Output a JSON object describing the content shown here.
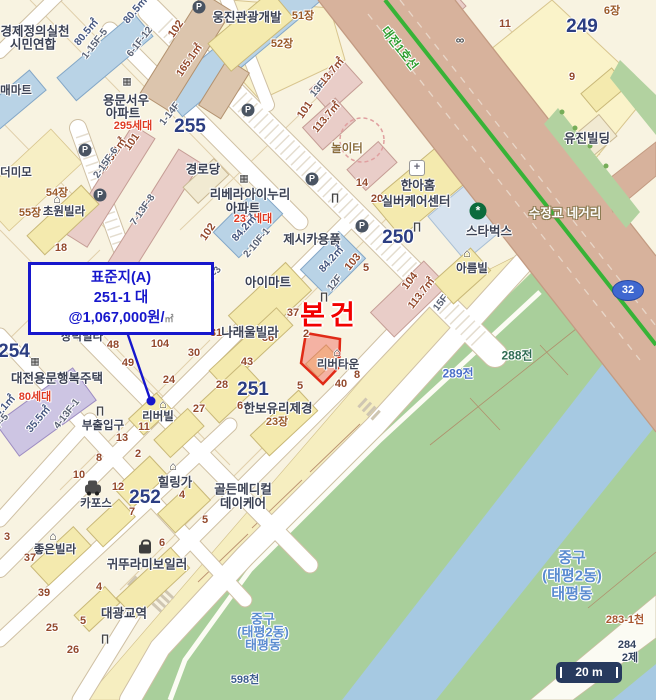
{
  "map": {
    "route_badge": "32",
    "scale_label": "20 m",
    "accent_colors": {
      "subject_red": "#f20000",
      "callout_blue": "#1717cc",
      "subway_green": "#37b337",
      "water": "#a6c9e2",
      "park_green": "#a9cf9b",
      "road_tan": "#d7b29c"
    }
  },
  "callout": {
    "line1": "표준지(A)",
    "line2": "251-1 대",
    "line3": "@1,067,000원/",
    "unit": "㎡"
  },
  "labels": [
    {
      "t": "경제정의실천",
      "x": 35,
      "y": 30,
      "c": "bldg13"
    },
    {
      "t": "시민연합",
      "x": 33,
      "y": 43,
      "c": "bldg13"
    },
    {
      "t": "80.5㎡",
      "x": 86,
      "y": 32,
      "c": "areaB",
      "r": -50
    },
    {
      "t": "80.5㎡",
      "x": 135,
      "y": 10,
      "c": "areaB",
      "r": -50
    },
    {
      "t": "1-15F-5",
      "x": 95,
      "y": 44,
      "c": "floor",
      "r": -52
    },
    {
      "t": "6-1F-12",
      "x": 140,
      "y": 42,
      "c": "floor",
      "r": -52
    },
    {
      "t": "102",
      "x": 176,
      "y": 29,
      "c": "pnum",
      "r": -55
    },
    {
      "t": "165.1㎡",
      "x": 189,
      "y": 60,
      "c": "areaM",
      "r": -55
    },
    {
      "t": "매마트",
      "x": 16,
      "y": 90,
      "c": "bldg12"
    },
    {
      "t": "웅진관광개발",
      "x": 247,
      "y": 16,
      "c": "bldg13"
    },
    {
      "t": "51장",
      "x": 303,
      "y": 15,
      "c": "jang"
    },
    {
      "t": "52장",
      "x": 282,
      "y": 43,
      "c": "jang"
    },
    {
      "t": "용문서우",
      "x": 126,
      "y": 99,
      "c": "bldg13"
    },
    {
      "t": "아파트",
      "x": 123,
      "y": 112,
      "c": "bldg13"
    },
    {
      "t": "1-14F",
      "x": 170,
      "y": 114,
      "c": "floor",
      "r": -52
    },
    {
      "t": "295세대",
      "x": 133,
      "y": 125,
      "c": "red11"
    },
    {
      "t": "255",
      "x": 190,
      "y": 127,
      "c": "bignum"
    },
    {
      "t": "101",
      "x": 132,
      "y": 142,
      "c": "pnum",
      "r": -55
    },
    {
      "t": "103.2㎡",
      "x": 113,
      "y": 154,
      "c": "areaM",
      "r": -55
    },
    {
      "t": "2-15F-6",
      "x": 106,
      "y": 163,
      "c": "floor",
      "r": -55
    },
    {
      "t": "7-13F-8",
      "x": 143,
      "y": 210,
      "c": "floor",
      "r": -55
    },
    {
      "t": "더미모",
      "x": 16,
      "y": 172,
      "c": "bldg12"
    },
    {
      "t": "54장",
      "x": 57,
      "y": 192,
      "c": "jang"
    },
    {
      "t": "55장",
      "x": 30,
      "y": 212,
      "c": "jang"
    },
    {
      "t": "초원빌라",
      "x": 64,
      "y": 211,
      "c": "bldg12"
    },
    {
      "t": "18",
      "x": 61,
      "y": 248,
      "c": "pnum"
    },
    {
      "t": "113.7㎡",
      "x": 330,
      "y": 73,
      "c": "areaM",
      "r": -50
    },
    {
      "t": "13F",
      "x": 318,
      "y": 89,
      "c": "floor",
      "r": -50
    },
    {
      "t": "101",
      "x": 305,
      "y": 110,
      "c": "pnum",
      "r": -55
    },
    {
      "t": "113.7㎡",
      "x": 326,
      "y": 117,
      "c": "areaM",
      "r": -50
    },
    {
      "t": "놀이터",
      "x": 347,
      "y": 148,
      "c": "play"
    },
    {
      "t": "경로당",
      "x": 203,
      "y": 168,
      "c": "bldg13"
    },
    {
      "t": "리베라아이누리",
      "x": 250,
      "y": 193,
      "c": "bldg13"
    },
    {
      "t": "아파트",
      "x": 243,
      "y": 207,
      "c": "bldg13"
    },
    {
      "t": "232세대",
      "x": 253,
      "y": 218,
      "c": "red11"
    },
    {
      "t": "84.2㎡",
      "x": 244,
      "y": 228,
      "c": "areaB",
      "r": -48
    },
    {
      "t": "2-10F-1",
      "x": 257,
      "y": 243,
      "c": "floor",
      "r": -50
    },
    {
      "t": "102",
      "x": 208,
      "y": 232,
      "c": "pnum",
      "r": -55
    },
    {
      "t": "2-9F-3",
      "x": 211,
      "y": 280,
      "c": "floor",
      "r": -55
    },
    {
      "t": "제시카용품",
      "x": 312,
      "y": 238,
      "c": "bldg13"
    },
    {
      "t": "84.2㎡",
      "x": 331,
      "y": 259,
      "c": "areaB",
      "r": -48
    },
    {
      "t": "103",
      "x": 353,
      "y": 262,
      "c": "pnum",
      "r": -50
    },
    {
      "t": "5",
      "x": 366,
      "y": 268,
      "c": "pnum"
    },
    {
      "t": "250",
      "x": 398,
      "y": 238,
      "c": "bignum"
    },
    {
      "t": "14",
      "x": 362,
      "y": 183,
      "c": "pnum"
    },
    {
      "t": "20",
      "x": 377,
      "y": 199,
      "c": "pnum"
    },
    {
      "t": "한아홈",
      "x": 418,
      "y": 184,
      "c": "bldg13"
    },
    {
      "t": "실버케어센터",
      "x": 416,
      "y": 200,
      "c": "bldg13"
    },
    {
      "t": "스타벅스",
      "x": 489,
      "y": 230,
      "c": "bldg13"
    },
    {
      "t": "아름빌",
      "x": 472,
      "y": 268,
      "c": "bldg12"
    },
    {
      "t": "104",
      "x": 410,
      "y": 281,
      "c": "pnum",
      "r": -52
    },
    {
      "t": "113.7㎡",
      "x": 421,
      "y": 293,
      "c": "areaM",
      "r": -52
    },
    {
      "t": "15F",
      "x": 441,
      "y": 303,
      "c": "floor",
      "r": -52
    },
    {
      "t": "12F",
      "x": 335,
      "y": 283,
      "c": "floor",
      "r": -52
    },
    {
      "t": "본건",
      "x": 330,
      "y": 313,
      "c": "subject",
      "n": "subject-property-label"
    },
    {
      "t": "리버타운",
      "x": 338,
      "y": 364,
      "c": "bldg12"
    },
    {
      "t": "37",
      "x": 293,
      "y": 313,
      "c": "pnum"
    },
    {
      "t": "2",
      "x": 306,
      "y": 334,
      "c": "pnum"
    },
    {
      "t": "5",
      "x": 300,
      "y": 386,
      "c": "pnum"
    },
    {
      "t": "40",
      "x": 341,
      "y": 384,
      "c": "pnum"
    },
    {
      "t": "8",
      "x": 357,
      "y": 375,
      "c": "pnum"
    },
    {
      "t": "아이마트",
      "x": 268,
      "y": 281,
      "c": "bldg13"
    },
    {
      "t": "36",
      "x": 268,
      "y": 338,
      "c": "pnum"
    },
    {
      "t": "31",
      "x": 216,
      "y": 333,
      "c": "pnum"
    },
    {
      "t": "나래울빌라",
      "x": 250,
      "y": 331,
      "c": "bldg13"
    },
    {
      "t": "104",
      "x": 160,
      "y": 344,
      "c": "pnum"
    },
    {
      "t": "30",
      "x": 194,
      "y": 353,
      "c": "pnum"
    },
    {
      "t": "43",
      "x": 247,
      "y": 362,
      "c": "pnum"
    },
    {
      "t": "24",
      "x": 169,
      "y": 380,
      "c": "pnum"
    },
    {
      "t": "28",
      "x": 222,
      "y": 385,
      "c": "pnum"
    },
    {
      "t": "251",
      "x": 253,
      "y": 390,
      "c": "bignum"
    },
    {
      "t": "6",
      "x": 240,
      "y": 406,
      "c": "pnum"
    },
    {
      "t": "한보유리제경",
      "x": 278,
      "y": 407,
      "c": "bldg13"
    },
    {
      "t": "23장",
      "x": 277,
      "y": 421,
      "c": "jang"
    },
    {
      "t": "27",
      "x": 199,
      "y": 409,
      "c": "pnum"
    },
    {
      "t": "리버빌",
      "x": 158,
      "y": 416,
      "c": "bldg12"
    },
    {
      "t": "11",
      "x": 144,
      "y": 427,
      "c": "pnum"
    },
    {
      "t": "부출입구",
      "x": 103,
      "y": 425,
      "c": "bldg12"
    },
    {
      "t": "13",
      "x": 122,
      "y": 438,
      "c": "pnum"
    },
    {
      "t": "48",
      "x": 113,
      "y": 345,
      "c": "pnum"
    },
    {
      "t": "49",
      "x": 128,
      "y": 363,
      "c": "pnum"
    },
    {
      "t": "장덕빌라",
      "x": 82,
      "y": 336,
      "c": "bldg12"
    },
    {
      "t": "254",
      "x": 14,
      "y": 352,
      "c": "bignum"
    },
    {
      "t": "대전용문행복주택",
      "x": 57,
      "y": 377,
      "c": "bldg13"
    },
    {
      "t": "80세대",
      "x": 35,
      "y": 396,
      "c": "red11"
    },
    {
      "t": "35.5㎡",
      "x": 38,
      "y": 419,
      "c": "areaB",
      "r": -50
    },
    {
      "t": "4-13F-1",
      "x": 67,
      "y": 414,
      "c": "floor",
      "r": -52
    },
    {
      "t": "29.1㎡",
      "x": 3,
      "y": 408,
      "c": "areaB",
      "r": -50
    },
    {
      "t": "10-6F-5",
      "x": -4,
      "y": 429,
      "c": "floor",
      "r": -52
    },
    {
      "t": "10",
      "x": 79,
      "y": 475,
      "c": "pnum"
    },
    {
      "t": "8",
      "x": 99,
      "y": 458,
      "c": "pnum"
    },
    {
      "t": "2",
      "x": 138,
      "y": 454,
      "c": "pnum"
    },
    {
      "t": "12",
      "x": 118,
      "y": 487,
      "c": "pnum"
    },
    {
      "t": "카포스",
      "x": 96,
      "y": 503,
      "c": "bldg12"
    },
    {
      "t": "힐링가",
      "x": 175,
      "y": 481,
      "c": "bldg13"
    },
    {
      "t": "252",
      "x": 145,
      "y": 498,
      "c": "bignum"
    },
    {
      "t": "4",
      "x": 182,
      "y": 495,
      "c": "pnum"
    },
    {
      "t": "7",
      "x": 132,
      "y": 512,
      "c": "pnum"
    },
    {
      "t": "5",
      "x": 205,
      "y": 520,
      "c": "pnum"
    },
    {
      "t": "골든메디컬",
      "x": 243,
      "y": 488,
      "c": "bldg13"
    },
    {
      "t": "데이케어",
      "x": 243,
      "y": 502,
      "c": "bldg13"
    },
    {
      "t": "좋은빌라",
      "x": 55,
      "y": 549,
      "c": "bldg12"
    },
    {
      "t": "3",
      "x": 7,
      "y": 537,
      "c": "pnum"
    },
    {
      "t": "37",
      "x": 30,
      "y": 558,
      "c": "pnum"
    },
    {
      "t": "6",
      "x": 162,
      "y": 543,
      "c": "pnum"
    },
    {
      "t": "귀뚜라미보일러",
      "x": 147,
      "y": 563,
      "c": "bldg13"
    },
    {
      "t": "39",
      "x": 44,
      "y": 593,
      "c": "pnum"
    },
    {
      "t": "4",
      "x": 99,
      "y": 587,
      "c": "pnum"
    },
    {
      "t": "대광교역",
      "x": 124,
      "y": 612,
      "c": "bldg13"
    },
    {
      "t": "25",
      "x": 52,
      "y": 628,
      "c": "pnum"
    },
    {
      "t": "5",
      "x": 83,
      "y": 621,
      "c": "pnum"
    },
    {
      "t": "26",
      "x": 73,
      "y": 650,
      "c": "pnum"
    },
    {
      "t": "중구",
      "x": 263,
      "y": 618,
      "c": "district13",
      "n": "district-name"
    },
    {
      "t": "(태평2동)",
      "x": 263,
      "y": 631,
      "c": "district13",
      "n": "district-name"
    },
    {
      "t": "태평동",
      "x": 263,
      "y": 644,
      "c": "district13",
      "n": "district-name"
    },
    {
      "t": "598천",
      "x": 245,
      "y": 679,
      "c": "cheon"
    },
    {
      "t": "288전",
      "x": 517,
      "y": 355,
      "c": "jeonG"
    },
    {
      "t": "289전",
      "x": 458,
      "y": 373,
      "c": "jeonB"
    },
    {
      "t": "중구",
      "x": 572,
      "y": 557,
      "c": "district15",
      "n": "district-name"
    },
    {
      "t": "(태평2동)",
      "x": 572,
      "y": 575,
      "c": "district15",
      "n": "district-name"
    },
    {
      "t": "태평동",
      "x": 572,
      "y": 593,
      "c": "district15",
      "n": "district-name"
    },
    {
      "t": "283-1천",
      "x": 625,
      "y": 619,
      "c": "cheonO"
    },
    {
      "t": "284",
      "x": 627,
      "y": 645,
      "c": "navy11"
    },
    {
      "t": "2제",
      "x": 630,
      "y": 657,
      "c": "navy11"
    },
    {
      "t": "249",
      "x": 582,
      "y": 27,
      "c": "bignum"
    },
    {
      "t": "11",
      "x": 505,
      "y": 24,
      "c": "pnum"
    },
    {
      "t": "9",
      "x": 572,
      "y": 77,
      "c": "pnum"
    },
    {
      "t": "6장",
      "x": 612,
      "y": 10,
      "c": "jang"
    },
    {
      "t": "유진빌딩",
      "x": 587,
      "y": 137,
      "c": "bldg13"
    },
    {
      "t": "수정교 네거리",
      "x": 565,
      "y": 212,
      "c": "roadname",
      "n": "intersection-name"
    },
    {
      "t": "대전1호선",
      "x": 400,
      "y": 48,
      "c": "subway",
      "r": 52,
      "n": "subway-line-name"
    }
  ],
  "icons": [
    {
      "k": "p",
      "g": "P",
      "x": 199,
      "y": 7
    },
    {
      "k": "p",
      "g": "P",
      "x": 248,
      "y": 110
    },
    {
      "k": "p",
      "g": "P",
      "x": 85,
      "y": 150
    },
    {
      "k": "p",
      "g": "P",
      "x": 100,
      "y": 195
    },
    {
      "k": "p",
      "g": "P",
      "x": 312,
      "y": 179
    },
    {
      "k": "p",
      "g": "P",
      "x": 362,
      "y": 226
    },
    {
      "k": "house",
      "g": "⌂",
      "x": 57,
      "y": 199
    },
    {
      "k": "house",
      "g": "⌂",
      "x": 173,
      "y": 466
    },
    {
      "k": "house",
      "g": "⌂",
      "x": 53,
      "y": 536
    },
    {
      "k": "house",
      "g": "⌂",
      "x": 467,
      "y": 253
    },
    {
      "k": "house",
      "g": "⌂",
      "x": 337,
      "y": 352
    },
    {
      "k": "house",
      "g": "⌂",
      "x": 163,
      "y": 404
    },
    {
      "k": "apt",
      "g": "▦",
      "x": 127,
      "y": 82
    },
    {
      "k": "apt",
      "g": "▦",
      "x": 244,
      "y": 179
    },
    {
      "k": "apt",
      "g": "▦",
      "x": 35,
      "y": 362
    },
    {
      "k": "gate",
      "g": "∏",
      "x": 335,
      "y": 198
    },
    {
      "k": "gate",
      "g": "∏",
      "x": 417,
      "y": 227
    },
    {
      "k": "gate",
      "g": "∏",
      "x": 324,
      "y": 297
    },
    {
      "k": "gate",
      "g": "∏",
      "x": 100,
      "y": 411
    },
    {
      "k": "gate",
      "g": "∏",
      "x": 105,
      "y": 639
    },
    {
      "k": "plus",
      "g": "+",
      "x": 417,
      "y": 168
    },
    {
      "k": "star",
      "g": "*",
      "x": 478,
      "y": 211
    },
    {
      "k": "car",
      "g": "",
      "x": 93,
      "y": 489
    },
    {
      "k": "bag",
      "g": "",
      "x": 145,
      "y": 549
    },
    {
      "k": "bike",
      "g": "∞",
      "x": 460,
      "y": 40
    }
  ]
}
